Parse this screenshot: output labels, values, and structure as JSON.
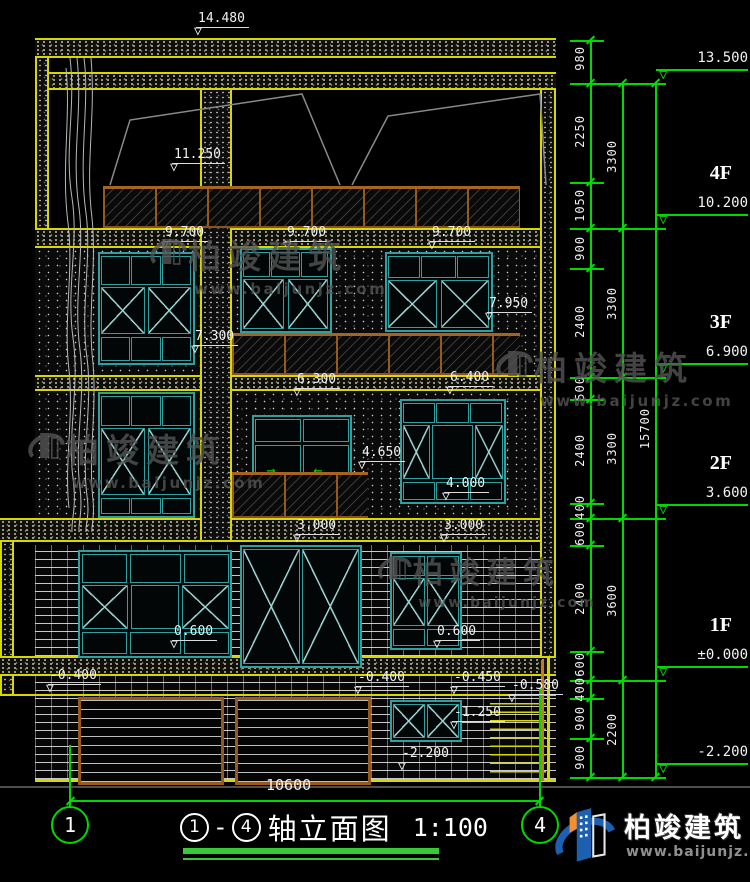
{
  "marks": {
    "a14480": "14.480",
    "a11250": "11.250",
    "a9700_1": "9.700",
    "a9700_2": "9.700",
    "a9700_3": "9.700",
    "a7950": "7.950",
    "a7300": "7.300",
    "a6300": "6.300",
    "a6400": "6.400",
    "a4650": "4.650",
    "a4000": "4.000",
    "a3000_1": "3.000",
    "a3000_2": "3.000",
    "a0600_1": "0.600",
    "a0600_2": "0.600",
    "n0400_1": "-0.400",
    "n0400_2": "-0.400",
    "n0450": "-0.450",
    "n0580": "-0.580",
    "n1250": "-1.250",
    "n2200": "-2.200"
  },
  "levels": [
    {
      "floor": "",
      "value": "13.500"
    },
    {
      "floor": "4F",
      "value": "10.200"
    },
    {
      "floor": "3F",
      "value": "6.900"
    },
    {
      "floor": "2F",
      "value": "3.600"
    },
    {
      "floor": "1F",
      "value": "±0.000"
    },
    {
      "floor": "",
      "value": "-2.200"
    }
  ],
  "dims": {
    "col1": [
      "980",
      "2250",
      "1050",
      "900",
      "2400",
      "500",
      "2400",
      "400",
      "600",
      "2400",
      "600",
      "400",
      "900",
      "900"
    ],
    "col2": [
      "3300",
      "3300",
      "3300",
      "3600",
      "2200"
    ],
    "col3": [
      "15700"
    ],
    "width": "10600"
  },
  "axes": {
    "left": "1",
    "right": "4"
  },
  "title": {
    "axis_a": "1",
    "dash": "-",
    "axis_b": "4",
    "name": "轴立面图",
    "scale": "1:100"
  },
  "brand": {
    "name": "柏竣建筑",
    "url": "www.baijunjz.com"
  },
  "colors": {
    "line_yellow": "#d8d800",
    "line_green": "#00d800",
    "window_cyan": "#2fa0a0",
    "rail_brown": "#96591e",
    "logo_blue": "#1d5fb0",
    "logo_orange": "#f09030"
  }
}
